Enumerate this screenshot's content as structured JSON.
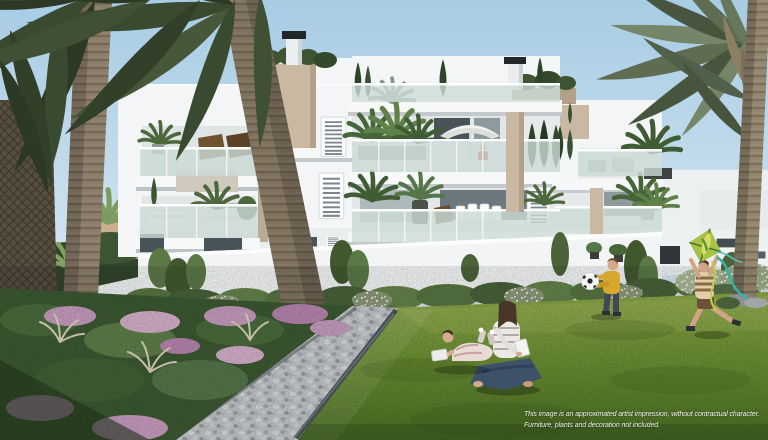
{
  "disclaimer": {
    "line1": "This image is an approximated artist impression, without contractual character.",
    "line2": "Furniture, plants and decoration not included."
  },
  "colors": {
    "sky_top": "#a7cce4",
    "sky_horizon": "#ddeaf2",
    "building_white": "#f3f5f6",
    "accent_beige": "#c9b8a2",
    "glass_tint": "#ccdcd7",
    "window_dark": "#49545a",
    "chimney_cap": "#22272a",
    "lawn_light": "#8aa647",
    "lawn_mid": "#6b8f33",
    "lawn_dark": "#4a6d24",
    "pebble_light": "#c2c5c8",
    "path_edge": "#4e565b",
    "flower_pink": "#c59bbd",
    "foliage_dark": "#35452d",
    "palm_frond": "#3a4a31",
    "palm_frond_right": "#5e6d52",
    "trunk_brown": "#8b7d69",
    "shirt_yellow": "#d8a72e",
    "shirt_red": "#b33a30",
    "kite_green": "#a6c347",
    "ribbon_teal": "#35b2a0",
    "jeans_blue": "#3d5168"
  }
}
